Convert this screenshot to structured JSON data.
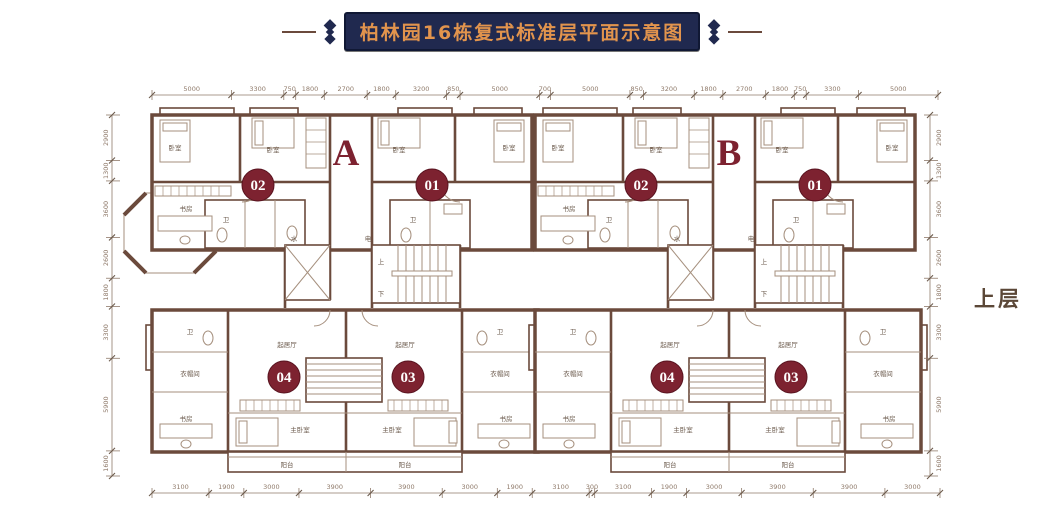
{
  "title": {
    "text": "柏林园16栋复式标准层平面示意图"
  },
  "floor_label": "上层",
  "sections": {
    "a": "A",
    "b": "B"
  },
  "units": {
    "u01": "01",
    "u02": "02",
    "u03": "03",
    "u04": "04"
  },
  "rooms": {
    "bedroom": "卧室",
    "study": "书房",
    "living": "起居厅",
    "master": "主卧室",
    "cloak": "衣帽间",
    "balcony": "阳台",
    "bath": "卫",
    "water": "水",
    "elec": "电",
    "up": "上",
    "down": "下"
  },
  "dimensions": {
    "top": [
      5000,
      3300,
      750,
      1800,
      2700,
      1800,
      3200,
      850,
      5000,
      700,
      5000,
      850,
      3200,
      1800,
      2700,
      1800,
      750,
      3300,
      5000
    ],
    "bottom": [
      3100,
      1900,
      3000,
      3900,
      3900,
      3000,
      1900,
      3100,
      300,
      3100,
      1900,
      3000,
      3900,
      3900,
      3000
    ],
    "left": [
      2900,
      1300,
      3600,
      2600,
      1800,
      3300,
      5900,
      1600
    ],
    "right": [
      2900,
      1300,
      3600,
      2600,
      1800,
      3300,
      5900,
      1600
    ]
  },
  "colors": {
    "wall": "#6b4a3c",
    "line": "#a58f7d",
    "dim": "#8f7a6a",
    "red": "#7d2230",
    "banner_bg": "#20294f",
    "banner_text": "#e2944d",
    "floor_text": "#5b4737"
  }
}
